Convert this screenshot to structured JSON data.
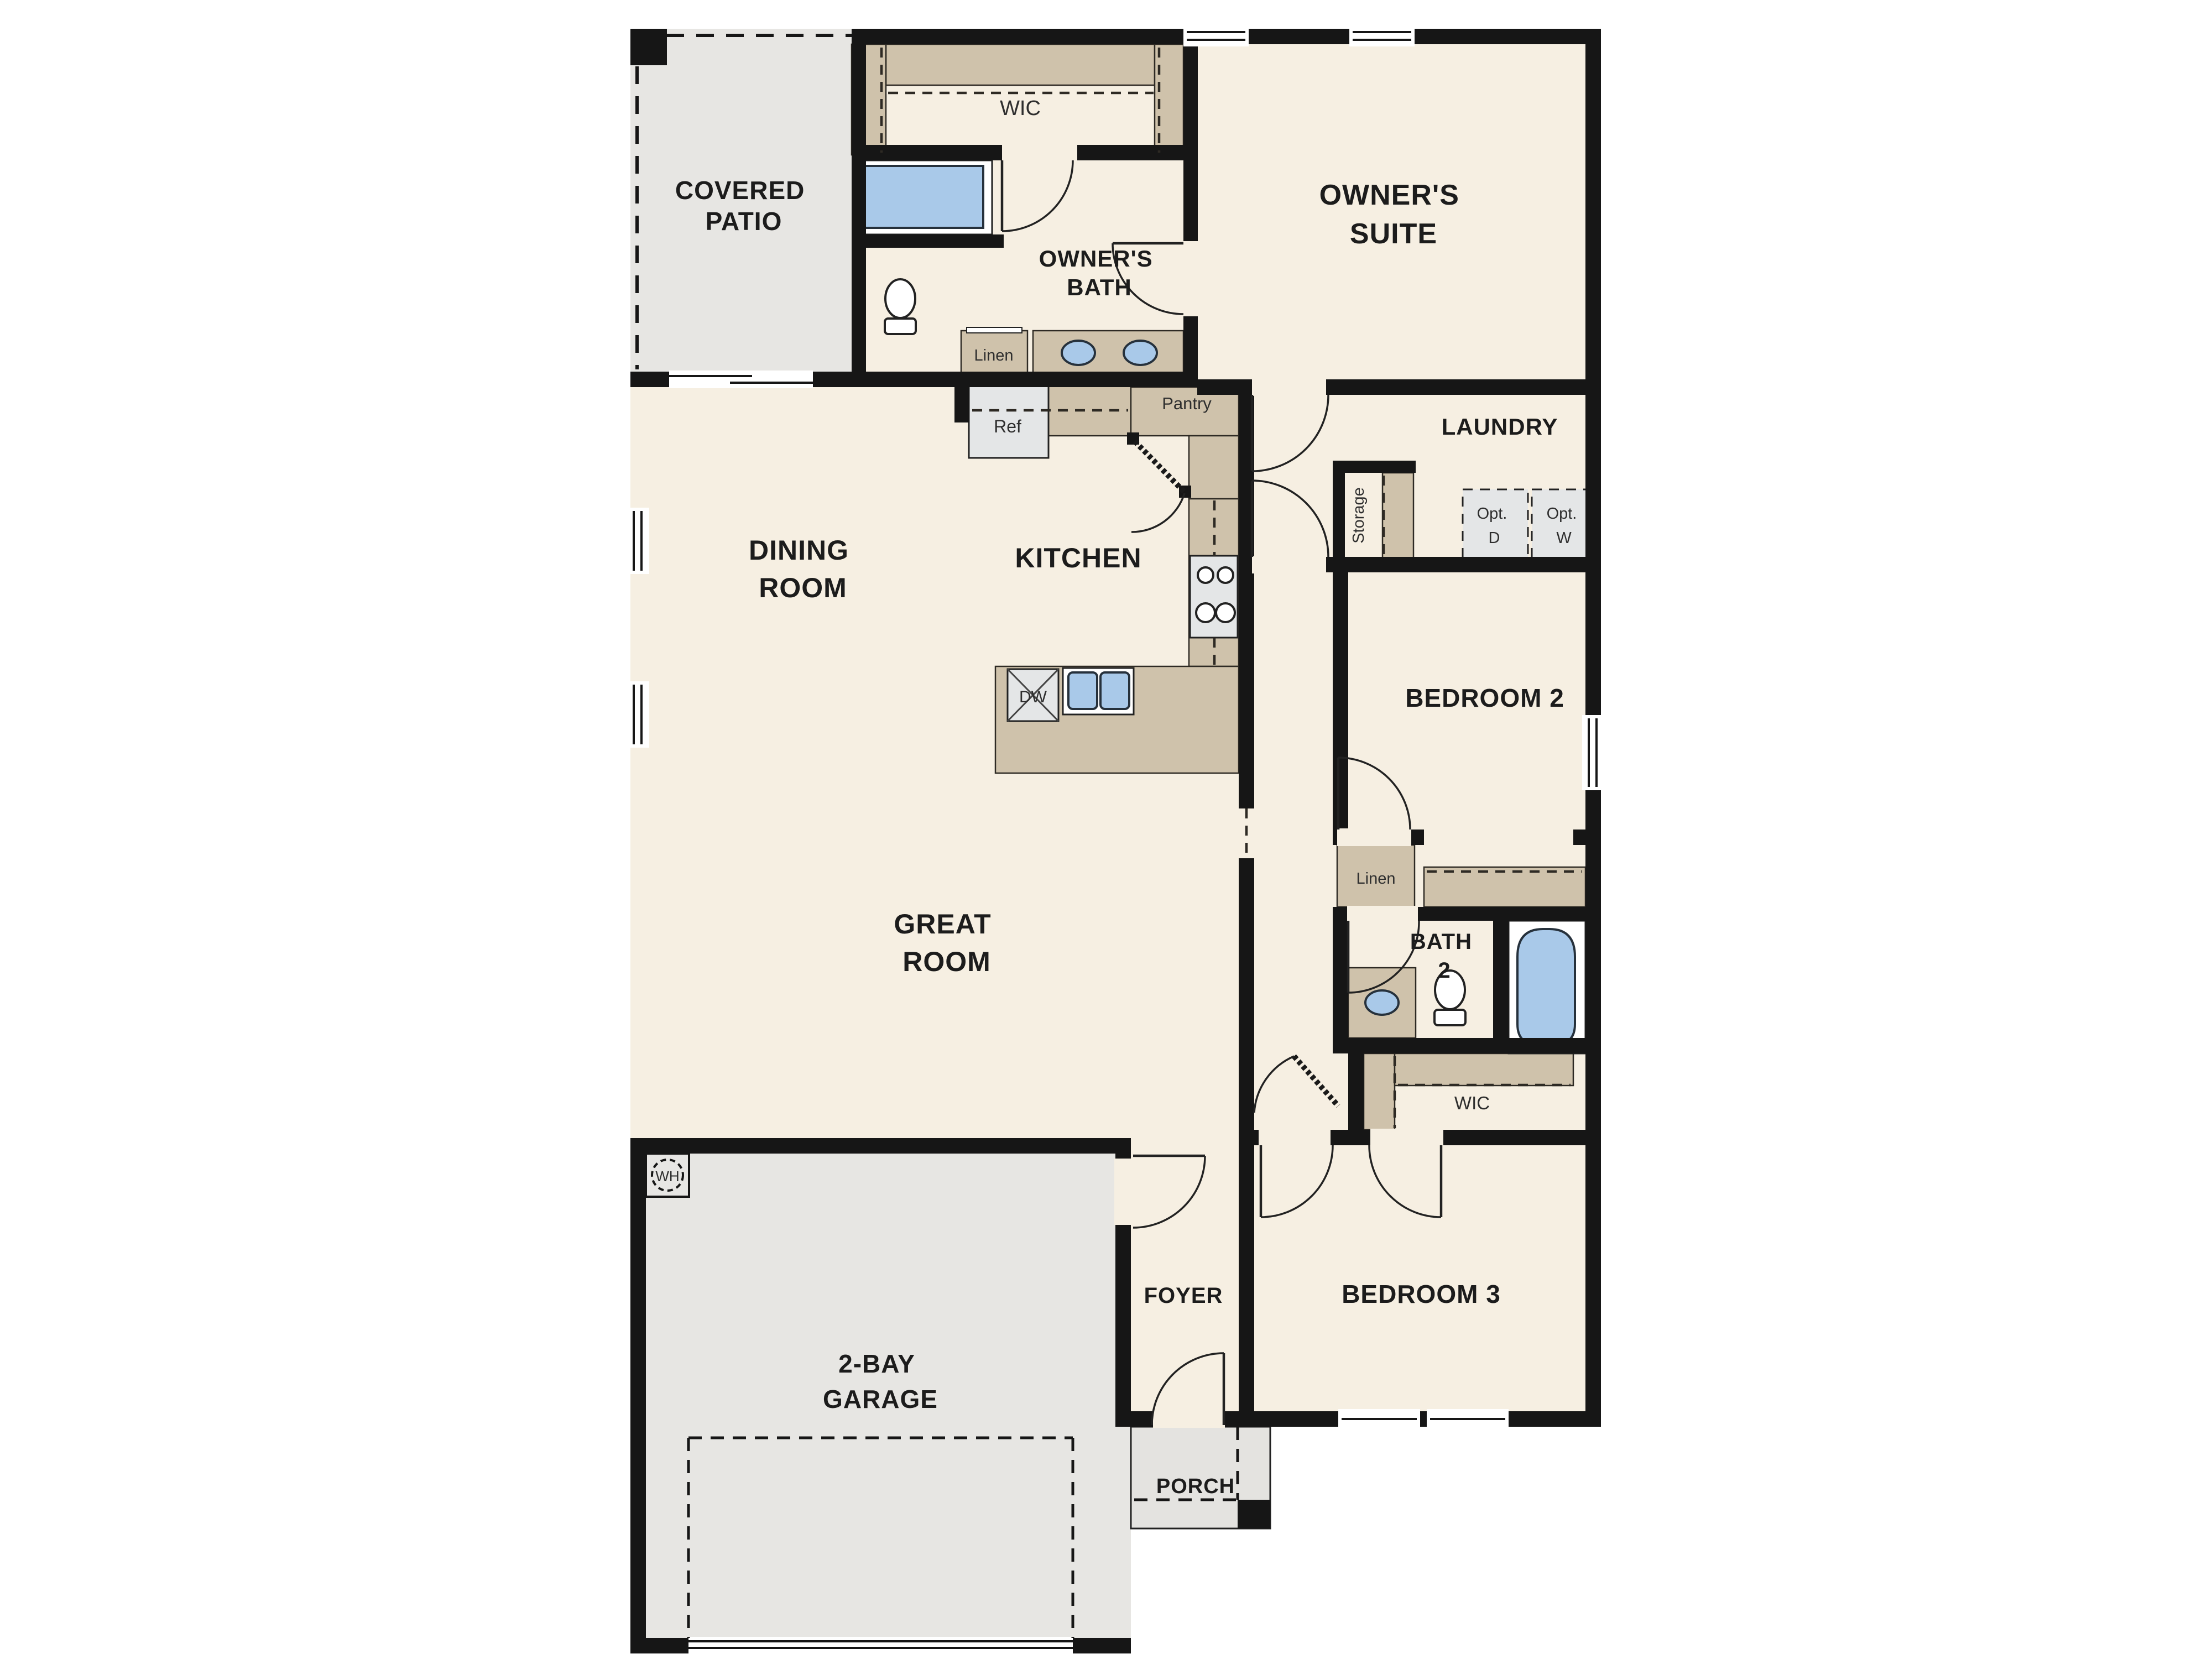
{
  "plan": {
    "rooms": {
      "covered_patio": {
        "line1": "COVERED",
        "line2": "PATIO"
      },
      "wic_top": {
        "label": "WIC"
      },
      "owners_bath": {
        "line1": "OWNER'S",
        "line2": "BATH"
      },
      "owners_suite": {
        "line1": "OWNER'S",
        "line2": "SUITE"
      },
      "laundry": {
        "label": "LAUNDRY"
      },
      "dining_room": {
        "line1": "DINING",
        "line2": "ROOM"
      },
      "kitchen": {
        "label": "KITCHEN"
      },
      "bedroom2": {
        "label": "BEDROOM 2"
      },
      "bath2": {
        "line1": "BATH",
        "line2": "2"
      },
      "wic_lower": {
        "label": "WIC"
      },
      "great_room": {
        "line1": "GREAT",
        "line2": "ROOM"
      },
      "foyer": {
        "label": "FOYER"
      },
      "bedroom3": {
        "label": "BEDROOM 3"
      },
      "garage": {
        "line1": "2-BAY",
        "line2": "GARAGE"
      },
      "porch": {
        "label": "PORCH"
      }
    },
    "fixtures": {
      "linen_owners_bath": "Linen",
      "linen_hall": "Linen",
      "ref": "Ref",
      "pantry": "Pantry",
      "storage": "Storage",
      "opt_dryer": {
        "line1": "Opt.",
        "line2": "D"
      },
      "opt_washer": {
        "line1": "Opt.",
        "line2": "W"
      },
      "dishwasher": "DW",
      "water_heater": "WH"
    },
    "palette": {
      "wall": "#161616",
      "floor": "#f6efe2",
      "outdoor": "#e7e6e3",
      "casework_tan": "#cfc2ab",
      "appliance_gray": "#e4e6e7",
      "fixture_blue": "#a9c9e9"
    }
  }
}
